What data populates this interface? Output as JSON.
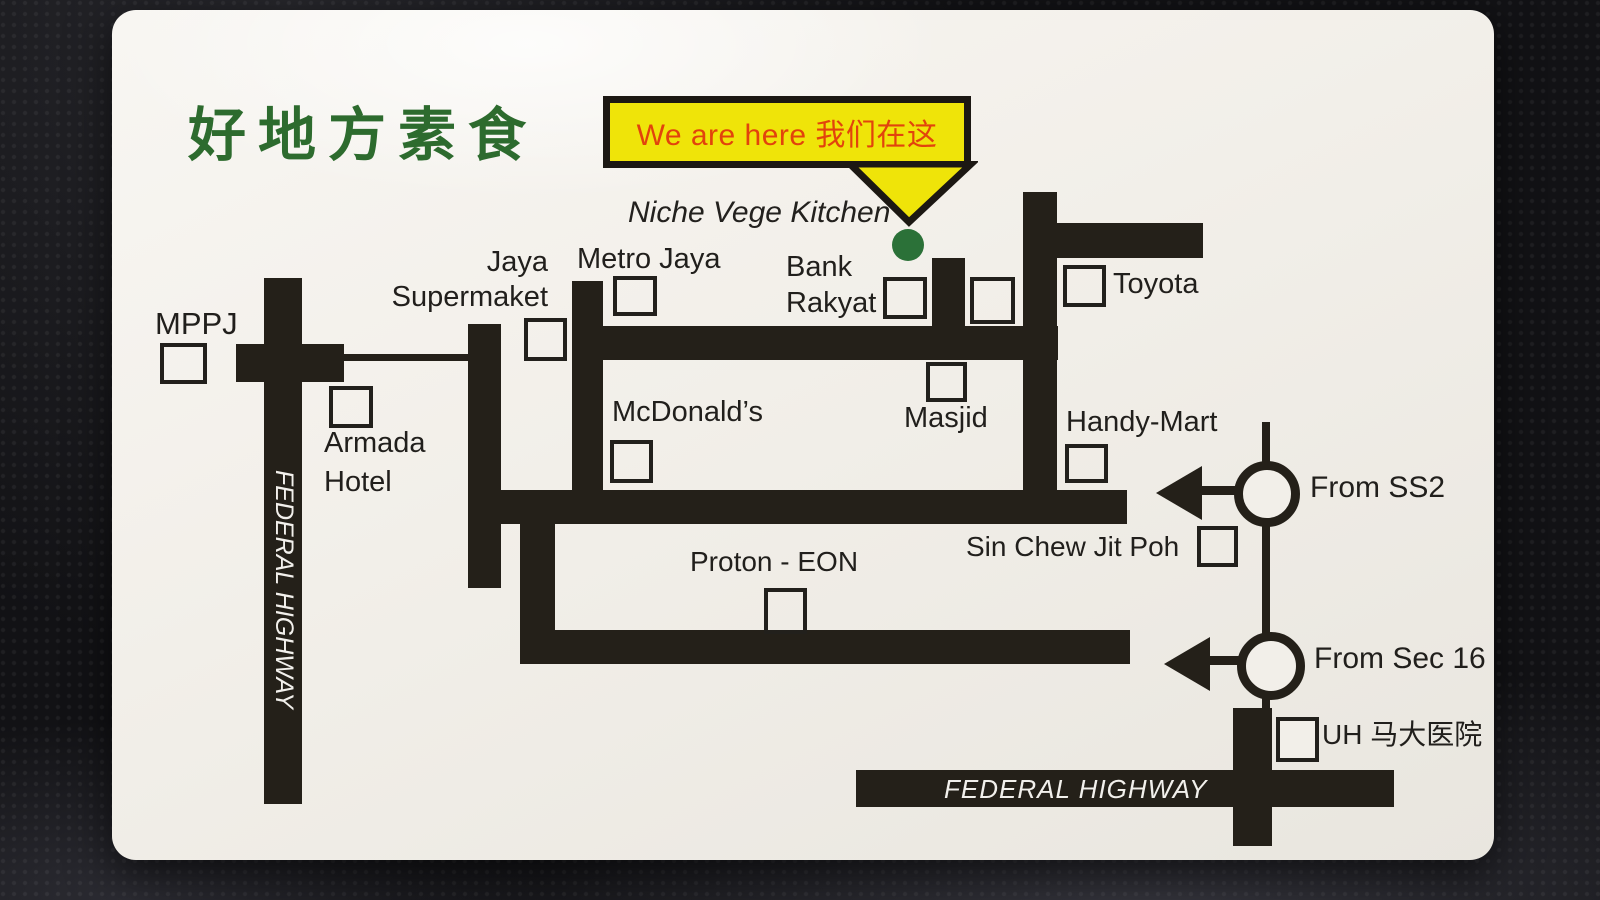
{
  "card_title": {
    "chinese_name": "好地方素食"
  },
  "callout": {
    "label": "We are here 我们在这"
  },
  "venue": {
    "name": "Niche Vege Kitchen"
  },
  "highways": {
    "left_vertical_label": "FEDERAL HIGHWAY",
    "bottom_label": "FEDERAL HIGHWAY"
  },
  "landmarks": {
    "mppj": "MPPJ",
    "jaya_supermarket": "Jaya Supermaket",
    "metro_jaya": "Metro Jaya",
    "bank_rakyat": "Bank Rakyat",
    "toyota": "Toyota",
    "armada_hotel": "Armada Hotel",
    "mcdonalds": "McDonald’s",
    "masjid": "Masjid",
    "handy_mart": "Handy-Mart",
    "sin_chew_jit_poh": "Sin Chew Jit Poh",
    "proton_eon": "Proton - EON",
    "uh_hospital": "UH 马大医院"
  },
  "directions": {
    "from_ss2": "From SS2",
    "from_sec16": "From Sec 16"
  },
  "colors": {
    "road": "#242019",
    "card": "#f2efe9",
    "callout_bg": "#efe409",
    "callout_text": "#e2430c",
    "title_green": "#2d6b2e",
    "location_dot_green": "#2b7138",
    "background": "#121215"
  }
}
